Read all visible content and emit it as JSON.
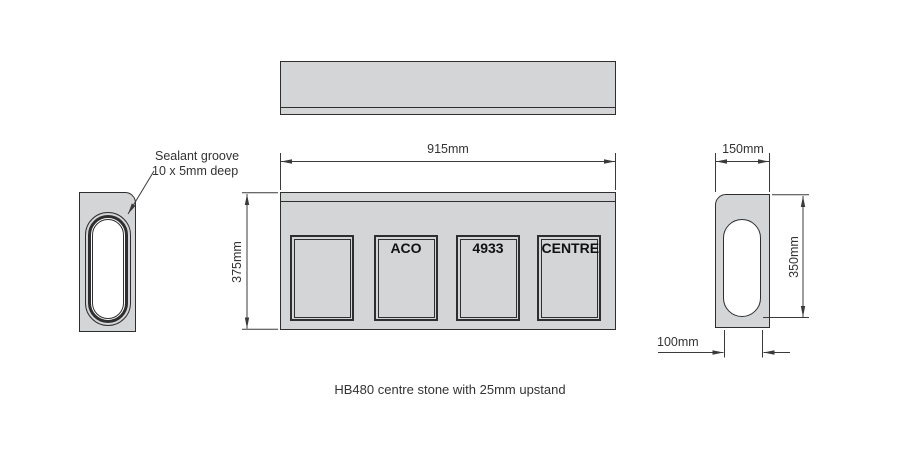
{
  "title": "HB480 centre stone with 25mm upstand",
  "callout": {
    "line1": "Sealant groove",
    "line2": "10 x 5mm deep"
  },
  "dimensions": {
    "overall_width": "915mm",
    "overall_height": "375mm",
    "end_width": "150mm",
    "end_height": "350mm",
    "channel_width": "100mm"
  },
  "views": {
    "plan": {
      "name": "plan view"
    },
    "front": {
      "panel_labels": [
        "",
        "ACO",
        "4933",
        "CENTRE"
      ]
    },
    "left_end": {
      "name": "left end view with sealant groove"
    },
    "right_end": {
      "name": "right end section view"
    }
  },
  "colors": {
    "stone_fill": "#d4d5d7",
    "line": "#2e2e2e",
    "dimension_line": "#3a3a3a",
    "panel_text": "#111111"
  }
}
